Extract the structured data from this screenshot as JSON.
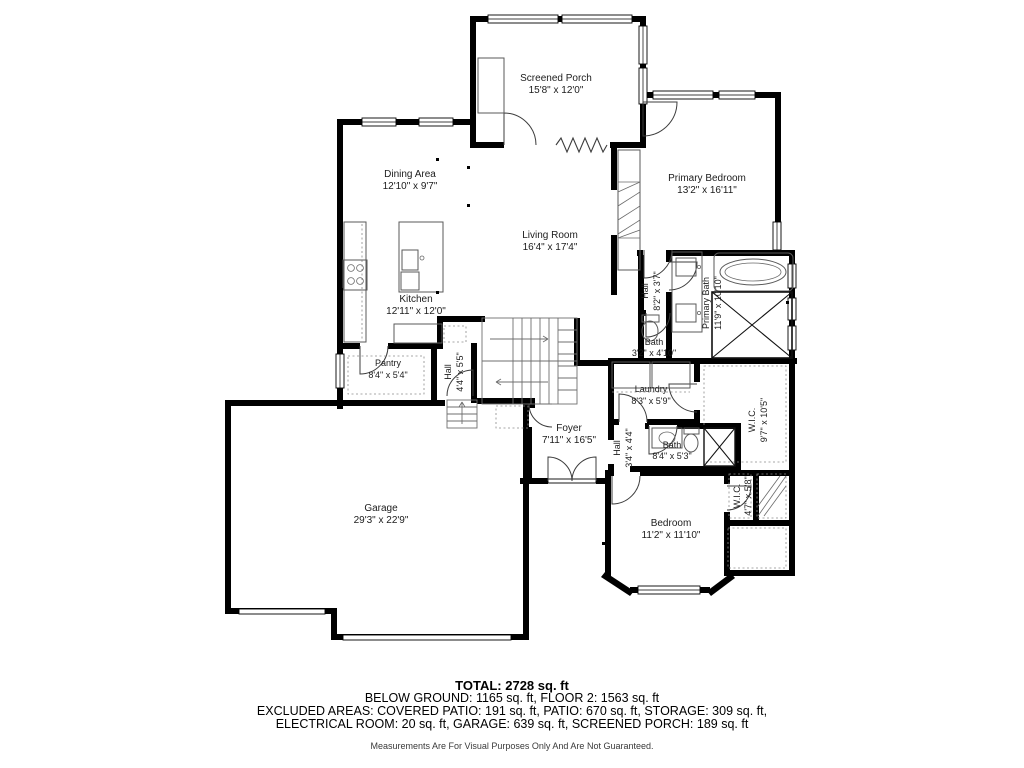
{
  "floor_plan": {
    "rooms": [
      {
        "id": "screened-porch",
        "name": "Screened Porch",
        "dims": "15'8\" x 12'0\""
      },
      {
        "id": "dining-area",
        "name": "Dining Area",
        "dims": "12'10\" x 9'7\""
      },
      {
        "id": "primary-bedroom",
        "name": "Primary Bedroom",
        "dims": "13'2\" x 16'11\""
      },
      {
        "id": "living-room",
        "name": "Living Room",
        "dims": "16'4\" x 17'4\""
      },
      {
        "id": "kitchen",
        "name": "Kitchen",
        "dims": "12'11\" x 12'0\""
      },
      {
        "id": "hall-upper",
        "name": "Hall",
        "dims": "8'2\" x 3'7\""
      },
      {
        "id": "primary-bath",
        "name": "Primary Bath",
        "dims": "11'9\" x 10'10\""
      },
      {
        "id": "bath-small",
        "name": "Bath",
        "dims": "3'2\" x 4'10\""
      },
      {
        "id": "pantry",
        "name": "Pantry",
        "dims": "8'4\" x 5'4\""
      },
      {
        "id": "hall-kitchen",
        "name": "Hall",
        "dims": "4'4\" x 5'5\""
      },
      {
        "id": "laundry",
        "name": "Laundry",
        "dims": "8'3\" x 5'9\""
      },
      {
        "id": "wic-primary",
        "name": "W.I.C.",
        "dims": "9'7\" x 10'5\""
      },
      {
        "id": "foyer",
        "name": "Foyer",
        "dims": "7'11\" x 16'5\""
      },
      {
        "id": "hall-foyer",
        "name": "Hall",
        "dims": "3'4\" x 4'4\""
      },
      {
        "id": "bath-hall",
        "name": "Bath",
        "dims": "8'4\" x 5'3\""
      },
      {
        "id": "wic-bedroom",
        "name": "W.I.C.",
        "dims": "4'7\" x 5'8\""
      },
      {
        "id": "garage",
        "name": "Garage",
        "dims": "29'3\" x 22'9\""
      },
      {
        "id": "bedroom",
        "name": "Bedroom",
        "dims": "11'2\" x 11'10\""
      }
    ],
    "footer": {
      "total": "TOTAL: 2728 sq. ft",
      "line2": "BELOW GROUND: 1165 sq. ft, FLOOR 2: 1563 sq. ft",
      "line3": "EXCLUDED AREAS: COVERED PATIO: 191 sq. ft, PATIO: 670 sq. ft, STORAGE: 309 sq. ft,",
      "line4": "ELECTRICAL ROOM: 20 sq. ft, GARAGE: 639 sq. ft, SCREENED PORCH: 189 sq. ft",
      "disclaimer": "Measurements Are For Visual Purposes Only And Are Not Guaranteed."
    },
    "colors": {
      "wall": "#000000",
      "fixture": "#5a5a5a",
      "text": "#1c1c1c"
    }
  }
}
